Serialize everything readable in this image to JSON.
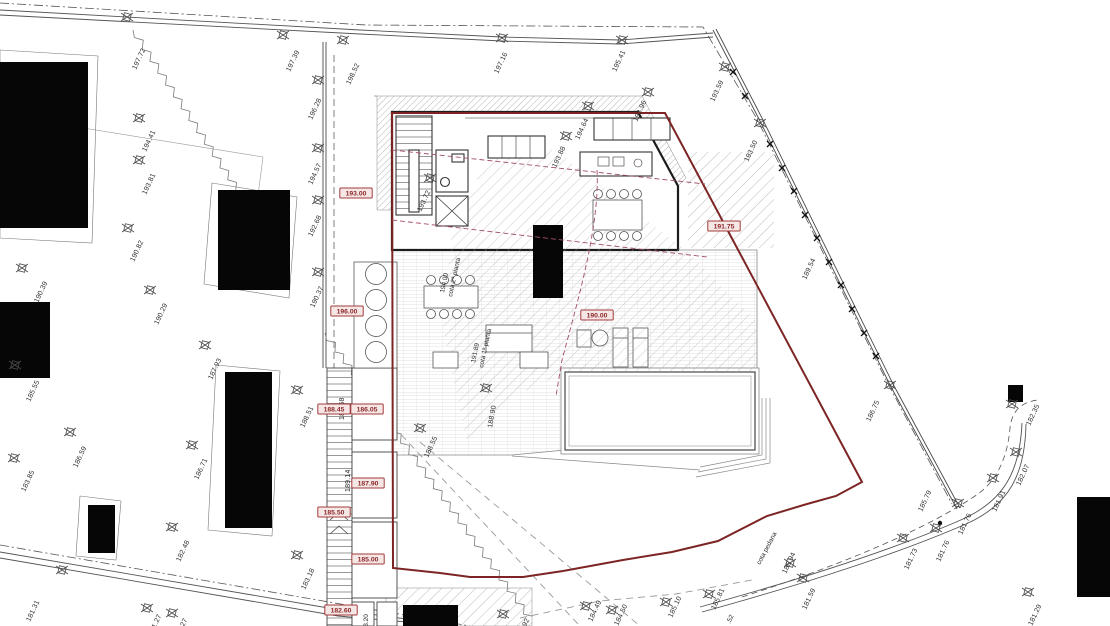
{
  "title": "site plan with building floor plan, pool and survey elevations",
  "colors": {
    "boundary_red": "#7d2424",
    "level_box_border": "#a23a3a",
    "level_box_fill": "#f6e7e7",
    "level_text": "#8d2727",
    "section_magenta": "#a34d68",
    "line_dark": "#444444",
    "hatch_gray": "#a8a8a8"
  },
  "levels": [
    {
      "v": "193.00",
      "x": 356,
      "y": 193
    },
    {
      "v": "196.00",
      "x": 347,
      "y": 311
    },
    {
      "v": "188.45",
      "x": 334,
      "y": 409
    },
    {
      "v": "186.05",
      "x": 367,
      "y": 409
    },
    {
      "v": "187.90",
      "x": 368,
      "y": 483
    },
    {
      "v": "185.50",
      "x": 334,
      "y": 512
    },
    {
      "v": "185.00",
      "x": 368,
      "y": 559
    },
    {
      "v": "182.60",
      "x": 341,
      "y": 610
    },
    {
      "v": "190.00",
      "x": 597,
      "y": 315
    },
    {
      "v": "191.75",
      "x": 724,
      "y": 226
    }
  ],
  "survey_points": [
    {
      "v": "197.72",
      "mx": 127,
      "my": 17,
      "lx": 136,
      "ly": 70,
      "rot": -65
    },
    {
      "v": "197.39",
      "mx": 283,
      "my": 35,
      "lx": 290,
      "ly": 72,
      "rot": -65
    },
    {
      "v": "198.52",
      "mx": 343,
      "my": 40,
      "lx": 350,
      "ly": 85,
      "rot": -65
    },
    {
      "v": "196.28",
      "mx": 318,
      "my": 80,
      "lx": 312,
      "ly": 120,
      "rot": -65
    },
    {
      "v": "194.41",
      "mx": 139,
      "my": 118,
      "lx": 146,
      "ly": 152,
      "rot": -65
    },
    {
      "v": "193.81",
      "mx": 139,
      "my": 160,
      "lx": 146,
      "ly": 195,
      "rot": -65
    },
    {
      "v": "194.57",
      "mx": 318,
      "my": 148,
      "lx": 312,
      "ly": 185,
      "rot": -65
    },
    {
      "v": "192.68",
      "mx": 318,
      "my": 200,
      "lx": 312,
      "ly": 237,
      "rot": -65
    },
    {
      "v": "190.82",
      "mx": 128,
      "my": 228,
      "lx": 134,
      "ly": 262,
      "rot": -65
    },
    {
      "v": "190.39",
      "mx": 22,
      "my": 268,
      "lx": 38,
      "ly": 303,
      "rot": -65
    },
    {
      "v": "190.29",
      "mx": 150,
      "my": 290,
      "lx": 158,
      "ly": 325,
      "rot": -65
    },
    {
      "v": "190.37",
      "mx": 318,
      "my": 272,
      "lx": 314,
      "ly": 308,
      "rot": -65
    },
    {
      "v": "187.93",
      "mx": 205,
      "my": 345,
      "lx": 212,
      "ly": 380,
      "rot": -65
    },
    {
      "v": "185.55",
      "mx": 15,
      "my": 365,
      "lx": 30,
      "ly": 402,
      "rot": -65
    },
    {
      "v": "186.59",
      "mx": 70,
      "my": 432,
      "lx": 77,
      "ly": 468,
      "rot": -65
    },
    {
      "v": "183.85",
      "mx": 14,
      "my": 458,
      "lx": 25,
      "ly": 492,
      "rot": -65
    },
    {
      "v": "186.71",
      "mx": 192,
      "my": 445,
      "lx": 198,
      "ly": 480,
      "rot": -65
    },
    {
      "v": "182.48",
      "mx": 172,
      "my": 527,
      "lx": 180,
      "ly": 562,
      "rot": -65
    },
    {
      "v": "183.18",
      "mx": 297,
      "my": 555,
      "lx": 305,
      "ly": 590,
      "rot": -65
    },
    {
      "v": "181.31",
      "mx": 62,
      "my": 570,
      "lx": 30,
      "ly": 622,
      "rot": -65
    },
    {
      "v": "181.27",
      "mx": 147,
      "my": 608,
      "lx": 152,
      "ly": 636,
      "rot": -65
    },
    {
      "v": "181.27",
      "mx": 172,
      "my": 613,
      "lx": 178,
      "ly": 640,
      "rot": -65
    },
    {
      "v": "188.51",
      "mx": 297,
      "my": 390,
      "lx": 304,
      "ly": 428,
      "rot": -65
    },
    {
      "v": "187.58",
      "lx": 344,
      "ly": 420,
      "rot": -90
    },
    {
      "v": "189.14",
      "lx": 350,
      "ly": 492,
      "rot": -90
    },
    {
      "v": "188.55",
      "mx": 420,
      "my": 428,
      "lx": 428,
      "ly": 458,
      "rot": -65
    },
    {
      "v": "188.90",
      "mx": 486,
      "my": 388,
      "lx": 492,
      "ly": 428,
      "rot": -80
    },
    {
      "v": "182.92",
      "mx": 503,
      "my": 614,
      "lx": 520,
      "ly": 640,
      "rot": -65
    },
    {
      "v": "184.49",
      "mx": 586,
      "my": 606,
      "lx": 592,
      "ly": 622,
      "rot": -65
    },
    {
      "v": "184.50",
      "mx": 612,
      "my": 610,
      "lx": 618,
      "ly": 626,
      "rot": -65
    },
    {
      "v": "185.10",
      "mx": 666,
      "my": 602,
      "lx": 672,
      "ly": 618,
      "rot": -65
    },
    {
      "v": "185.81",
      "mx": 709,
      "my": 594,
      "lx": 715,
      "ly": 610,
      "rot": -65
    },
    {
      "v": "185.94",
      "mx": 790,
      "my": 563,
      "lx": 786,
      "ly": 574,
      "rot": -65
    },
    {
      "v": "181.59",
      "mx": 803,
      "my": 578,
      "lx": 806,
      "ly": 610,
      "rot": -65
    },
    {
      "v": "181.73",
      "mx": 903,
      "my": 538,
      "lx": 908,
      "ly": 570,
      "rot": -65
    },
    {
      "v": "181.76",
      "mx": 936,
      "my": 528,
      "lx": 940,
      "ly": 562,
      "rot": -65
    },
    {
      "v": "181.76",
      "mx": 958,
      "my": 503,
      "lx": 962,
      "ly": 535,
      "rot": -65
    },
    {
      "v": "185.79",
      "lx": 922,
      "ly": 512,
      "rot": -65
    },
    {
      "v": "181.91",
      "mx": 993,
      "my": 478,
      "lx": 996,
      "ly": 512,
      "rot": -65
    },
    {
      "v": "182.07",
      "mx": 1016,
      "my": 452,
      "lx": 1020,
      "ly": 486,
      "rot": -65
    },
    {
      "v": "181.29",
      "mx": 1028,
      "my": 592,
      "lx": 1032,
      "ly": 626,
      "rot": -65
    },
    {
      "v": "186.75",
      "mx": 890,
      "my": 385,
      "lx": 870,
      "ly": 422,
      "rot": -65
    },
    {
      "v": "182.35",
      "mx": 1012,
      "my": 404,
      "lx": 1030,
      "ly": 426,
      "rot": -65
    },
    {
      "v": "193.50",
      "mx": 760,
      "my": 123,
      "lx": 748,
      "ly": 162,
      "rot": -65
    },
    {
      "v": "189.54",
      "lx": 806,
      "ly": 280,
      "rot": -65
    },
    {
      "v": "193.59",
      "mx": 725,
      "my": 67,
      "lx": 714,
      "ly": 102,
      "rot": -65
    },
    {
      "v": "195.41",
      "mx": 622,
      "my": 40,
      "lx": 616,
      "ly": 72,
      "rot": -65
    },
    {
      "v": "197.16",
      "mx": 502,
      "my": 38,
      "lx": 498,
      "ly": 74,
      "rot": -65
    },
    {
      "v": "193.96",
      "mx": 648,
      "my": 92,
      "lx": 637,
      "ly": 122,
      "rot": -65
    },
    {
      "v": "194.64",
      "mx": 588,
      "my": 106,
      "lx": 579,
      "ly": 140,
      "rot": -65
    },
    {
      "v": "193.88",
      "mx": 566,
      "my": 136,
      "lx": 556,
      "ly": 168,
      "rot": -65
    },
    {
      "v": "193.72",
      "mx": 430,
      "my": 178,
      "lx": 421,
      "ly": 212,
      "rot": -65
    }
  ],
  "notes": [
    {
      "t": "194.00",
      "x": 444,
      "y": 293,
      "rot": -78
    },
    {
      "t": "cota 2ª pianta",
      "x": 452,
      "y": 297,
      "rot": -78
    },
    {
      "t": "191.89",
      "x": 475,
      "y": 363,
      "rot": -78
    },
    {
      "t": "cota 1ª pianta",
      "x": 483,
      "y": 368,
      "rot": -78
    },
    {
      "t": "cota pedana",
      "x": 760,
      "y": 565,
      "rot": -62
    },
    {
      "t": "183.20",
      "x": 368,
      "y": 634,
      "rot": -90
    },
    {
      "t": ".52",
      "x": 730,
      "y": 624,
      "rot": -65
    }
  ]
}
